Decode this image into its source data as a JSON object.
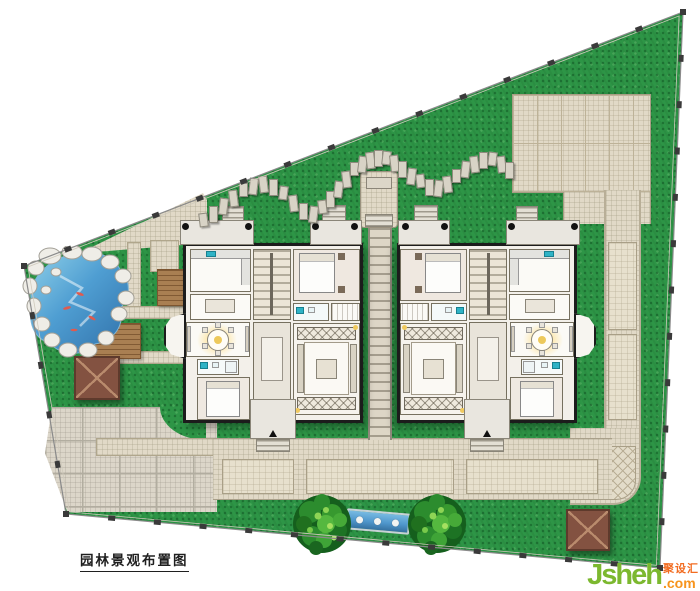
{
  "page": {
    "background": "#ffffff"
  },
  "title_block": {
    "label": "园林景观布置图"
  },
  "watermark": {
    "site_name": "Jsheh",
    "domain_suffix": ".com",
    "site_name_cn": "聚设汇",
    "green": "#7cb82f",
    "orange": "#f7941d",
    "orange_red": "#f26c21"
  },
  "site": {
    "boundary_points": [
      [
        683,
        12
      ],
      [
        660,
        568
      ],
      [
        66,
        514
      ],
      [
        24,
        266
      ]
    ],
    "units": [
      {
        "name": "villa-west",
        "mirrored": false
      },
      {
        "name": "villa-east",
        "mirrored": true
      }
    ],
    "features": [
      {
        "name": "koi-pond",
        "kind": "water"
      },
      {
        "name": "rock-border",
        "kind": "stone"
      },
      {
        "name": "wood-deck",
        "kind": "wood"
      },
      {
        "name": "wood-platform",
        "kind": "wood"
      },
      {
        "name": "gazebo-west",
        "kind": "pavilion"
      },
      {
        "name": "gazebo-southeast",
        "kind": "pavilion"
      },
      {
        "name": "stepping-stone-path",
        "kind": "path",
        "stone_count": 35
      },
      {
        "name": "plaza-northeast",
        "kind": "paving"
      },
      {
        "name": "plaza-southwest",
        "kind": "paving"
      },
      {
        "name": "south-promenade",
        "kind": "paving"
      },
      {
        "name": "east-walk",
        "kind": "paving"
      },
      {
        "name": "pergola-walk",
        "kind": "paving"
      },
      {
        "name": "entry-court-north",
        "kind": "paving"
      },
      {
        "name": "reflecting-channel",
        "kind": "water"
      },
      {
        "name": "round-tree-west",
        "kind": "tree"
      },
      {
        "name": "round-tree-east",
        "kind": "tree"
      }
    ],
    "colors": {
      "lawn": "#2d9546",
      "paving": "#e1d9c7",
      "paving_line": "#bdb298",
      "water": "#4f97cc",
      "wood": "#a97f52",
      "roof": "#835241",
      "wall": "#1c1c1c",
      "boundary": "#8a8a8a"
    }
  }
}
